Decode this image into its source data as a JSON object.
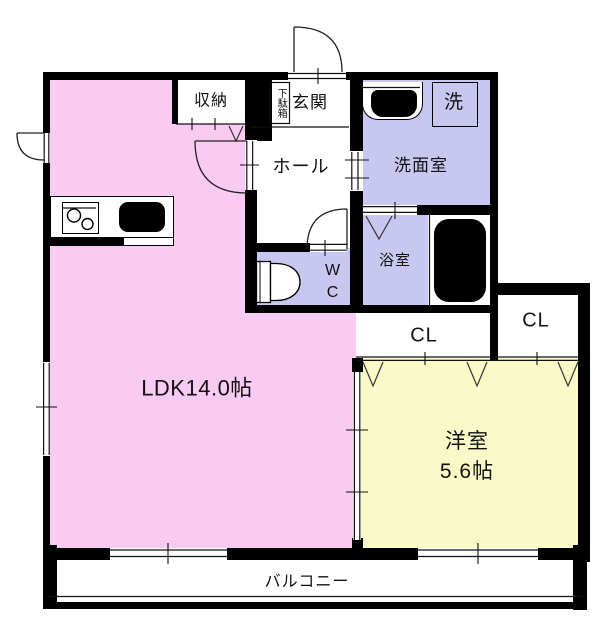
{
  "plan": {
    "ldk": {
      "label": "LDK14.0帖"
    },
    "western_room": {
      "name": "洋室",
      "size": "5.6帖"
    },
    "hall": {
      "label": "ホール"
    },
    "entrance": {
      "label": "玄関"
    },
    "shoe_box": {
      "label": "下駄箱"
    },
    "storage": {
      "label": "収納"
    },
    "washroom": {
      "label": "洗面室"
    },
    "washer_space": {
      "label": "洗"
    },
    "bathroom": {
      "label": "浴室"
    },
    "wc": {
      "line1": "W",
      "line2": "C"
    },
    "closet_inner": {
      "label": "CL"
    },
    "closet_outer": {
      "label": "CL"
    },
    "balcony": {
      "label": "バルコニー"
    },
    "colors": {
      "ldk_floor": "#f9cbf3",
      "western_floor": "#fafac8",
      "wet_area_floor": "#c7c7ef",
      "wall": "#000000"
    }
  }
}
